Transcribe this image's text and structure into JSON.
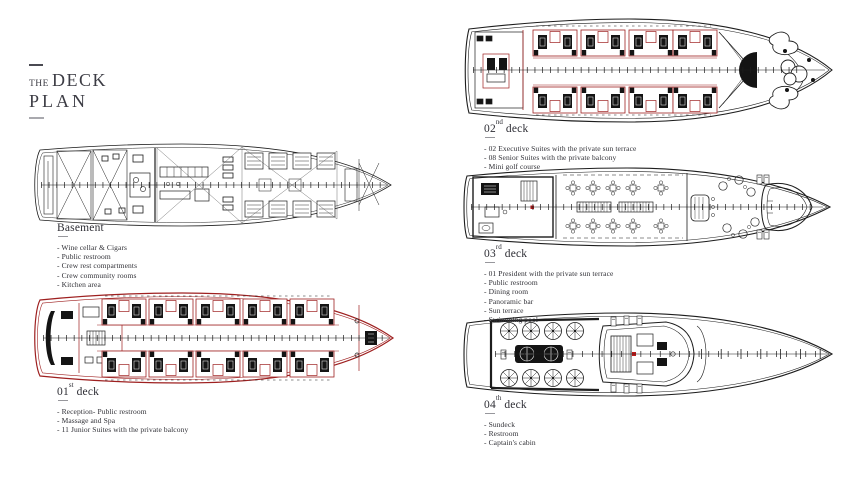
{
  "title": {
    "prefix": "THE",
    "word1": "DECK",
    "word2": "PLAN"
  },
  "colors": {
    "accent_red": "#9e2020",
    "ink": "#1d1d1d",
    "title_ink": "#3c3c44",
    "rule_gray": "#97979c",
    "background": "#ffffff"
  },
  "decks": [
    {
      "id": "basement",
      "label_num": "Basement",
      "label_ord": "",
      "label_word": "",
      "items": [
        "- Wine cellar & Cigars",
        "- Public restroom",
        "- Crew rest compartments",
        "- Crew community rooms",
        "- Kitchen area"
      ]
    },
    {
      "id": "deck-01",
      "label_num": "01",
      "label_ord": "st",
      "label_word": "deck",
      "items": [
        "- Reception- Public restroom",
        "- Massage and Spa",
        "- 11 Junior Suites with the private balcony"
      ]
    },
    {
      "id": "deck-02",
      "label_num": "02",
      "label_ord": "nd",
      "label_word": "deck",
      "items": [
        "- 02 Executive Suites with the private sun terrace",
        "- 08 Senior Suites with the private balcony",
        "- Mini golf course"
      ]
    },
    {
      "id": "deck-03",
      "label_num": "03",
      "label_ord": "rd",
      "label_word": "deck",
      "items": [
        "- 01 President with the private sun terrace",
        "- Public restroom",
        "- Dining room",
        "- Panoramic bar",
        "- Sun terrace",
        "- Swimming pool"
      ]
    },
    {
      "id": "deck-04",
      "label_num": "04",
      "label_ord": "th",
      "label_word": "deck",
      "items": [
        "- Sundeck",
        "- Restroom",
        "- Captain's cabin"
      ]
    }
  ]
}
